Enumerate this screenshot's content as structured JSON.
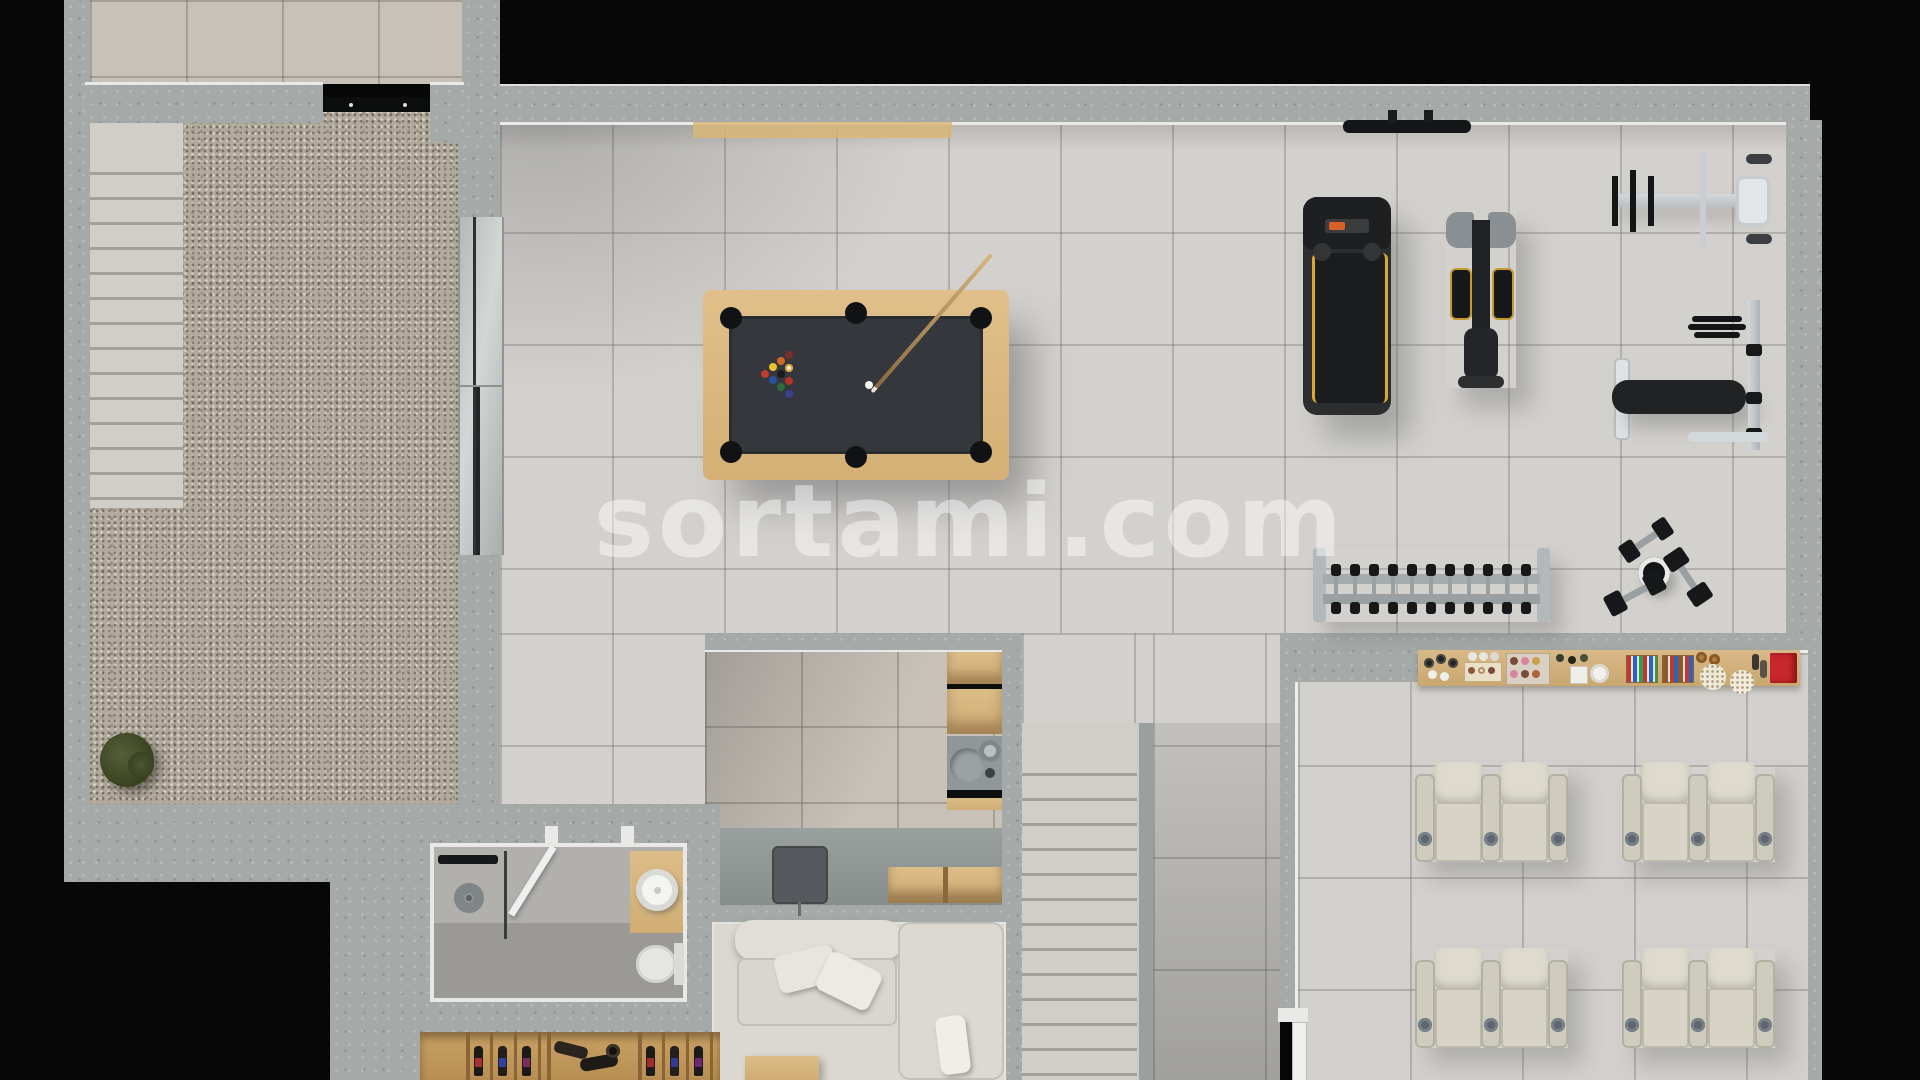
{
  "meta": {
    "title": "Basement / leisure floor plan 3D render",
    "watermark": "sortami.com",
    "view": "top-down architectural render"
  },
  "palette": {
    "background": "#070707",
    "concrete_wall": "#a5aaa8",
    "tile_floor": "#d3d1cd",
    "warm_tile": "#c7c1b8",
    "gravel": "#b2aa9d",
    "wood": "#d6b27c",
    "pool_felt": "#34373b",
    "cream_seat": "#d7d4c6",
    "treadmill_black": "#232527",
    "accent_yellow": "#d8a92c",
    "accent_orange": "#d96026",
    "popcorn_box_red": "#c8272c",
    "watermark_white": "rgba(255,255,255,0.45)"
  },
  "rooms": [
    {
      "id": "storage-room",
      "label": "top-left tiled room with sliding door"
    },
    {
      "id": "courtyard",
      "label": "gravel courtyard with exterior staircase and shrub"
    },
    {
      "id": "games-hall",
      "label": "main hall with billiard table"
    },
    {
      "id": "gym",
      "label": "home gym area"
    },
    {
      "id": "kitchenette",
      "label": "bar / kitchenette with shelves, sink and desk monitor"
    },
    {
      "id": "lounge",
      "label": "lounge with L-shaped sofa and coffee table"
    },
    {
      "id": "bathroom",
      "label": "bathroom with shower, vessel sink and toilet"
    },
    {
      "id": "wine-cellar",
      "label": "wine rack wall with bottles"
    },
    {
      "id": "staircase",
      "label": "interior staircase with handrail"
    },
    {
      "id": "cinema",
      "label": "home cinema with snack counter and recliners"
    }
  ],
  "objects": {
    "billiard_table": {
      "frame": "light oak",
      "felt": "dark graphite",
      "pockets": 6,
      "balls": "racked triangle + cue ball",
      "cue": 1
    },
    "gym_equipment": [
      "wall-mounted bar",
      "treadmill",
      "elliptical trainer",
      "shoulder press machine",
      "bench press with plates",
      "dumbbell rack",
      "loose dumbbells and plate"
    ],
    "dumbbells_on_rack": 11,
    "cinema_recliners": {
      "pairs": 4,
      "seats": 8,
      "cupholders_per_pair": 3
    },
    "snack_counter_items": [
      "bottles",
      "cups",
      "donut box",
      "cupcake tray",
      "plates",
      "candy boxes",
      "pretzels",
      "popcorn bowls",
      "red popcorn box"
    ],
    "bathroom_fixtures": [
      "rain shower",
      "glass door",
      "wooden vanity with round sink",
      "toilet"
    ],
    "lounge_items": [
      "cream L-sofa",
      "throw pillows",
      "wooden coffee table",
      "desk monitor"
    ],
    "wine_cellar": {
      "sections": "wooden cells",
      "bottles": "assorted dark bottles with colored labels"
    }
  }
}
